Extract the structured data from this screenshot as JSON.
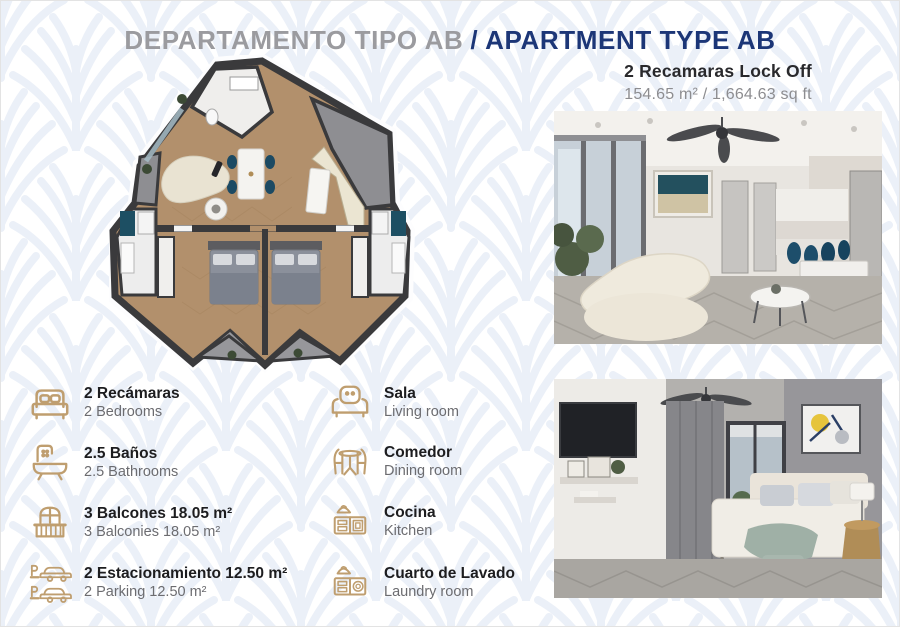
{
  "page": {
    "width": 900,
    "height": 627
  },
  "title": {
    "spanish": "DEPARTAMENTO TIPO AB",
    "separator": "/",
    "english": "APARTMENT TYPE AB"
  },
  "unit": {
    "name": "2 Recamaras Lock Off",
    "area": "154.65 m² / 1,664.63 sq ft"
  },
  "floorplan": {
    "name": "apartment-type-ab-floor-plan"
  },
  "photos": {
    "top": "living-dining-kitchen-photo",
    "bottom": "bedroom-photo"
  },
  "features": [
    {
      "icon": "bed-icon",
      "es": "2 Recámaras",
      "en": "2 Bedrooms"
    },
    {
      "icon": "bathtub-icon",
      "es": "2.5 Baños",
      "en": "2.5 Bathrooms"
    },
    {
      "icon": "balcony-icon",
      "es": "3 Balcones 18.05 m²",
      "en": "3 Balconies 18.05 m²"
    },
    {
      "icon": "parking-icon",
      "es": "2 Estacionamiento 12.50 m²",
      "en": "2 Parking 12.50 m²"
    },
    {
      "icon": "armchair-icon",
      "es": "Sala",
      "en": "Living room"
    },
    {
      "icon": "dining-table-icon",
      "es": "Comedor",
      "en": "Dining room"
    },
    {
      "icon": "kitchen-icon",
      "es": "Cocina",
      "en": "Kitchen"
    },
    {
      "icon": "laundry-icon",
      "es": "Cuarto de Lavado",
      "en": "Laundry room"
    }
  ],
  "colors": {
    "accent_gold": "#bf9e6f",
    "navy": "#1c3677",
    "title_gray": "#9b9b9f",
    "text_dark": "#1d1d1f",
    "text_gray": "#6c6c70",
    "pattern_blue": "#e9eef7",
    "plan_wall": "#3a3a3c",
    "plan_floor": "#b2906c",
    "chair_navy": "#1c4a63"
  }
}
